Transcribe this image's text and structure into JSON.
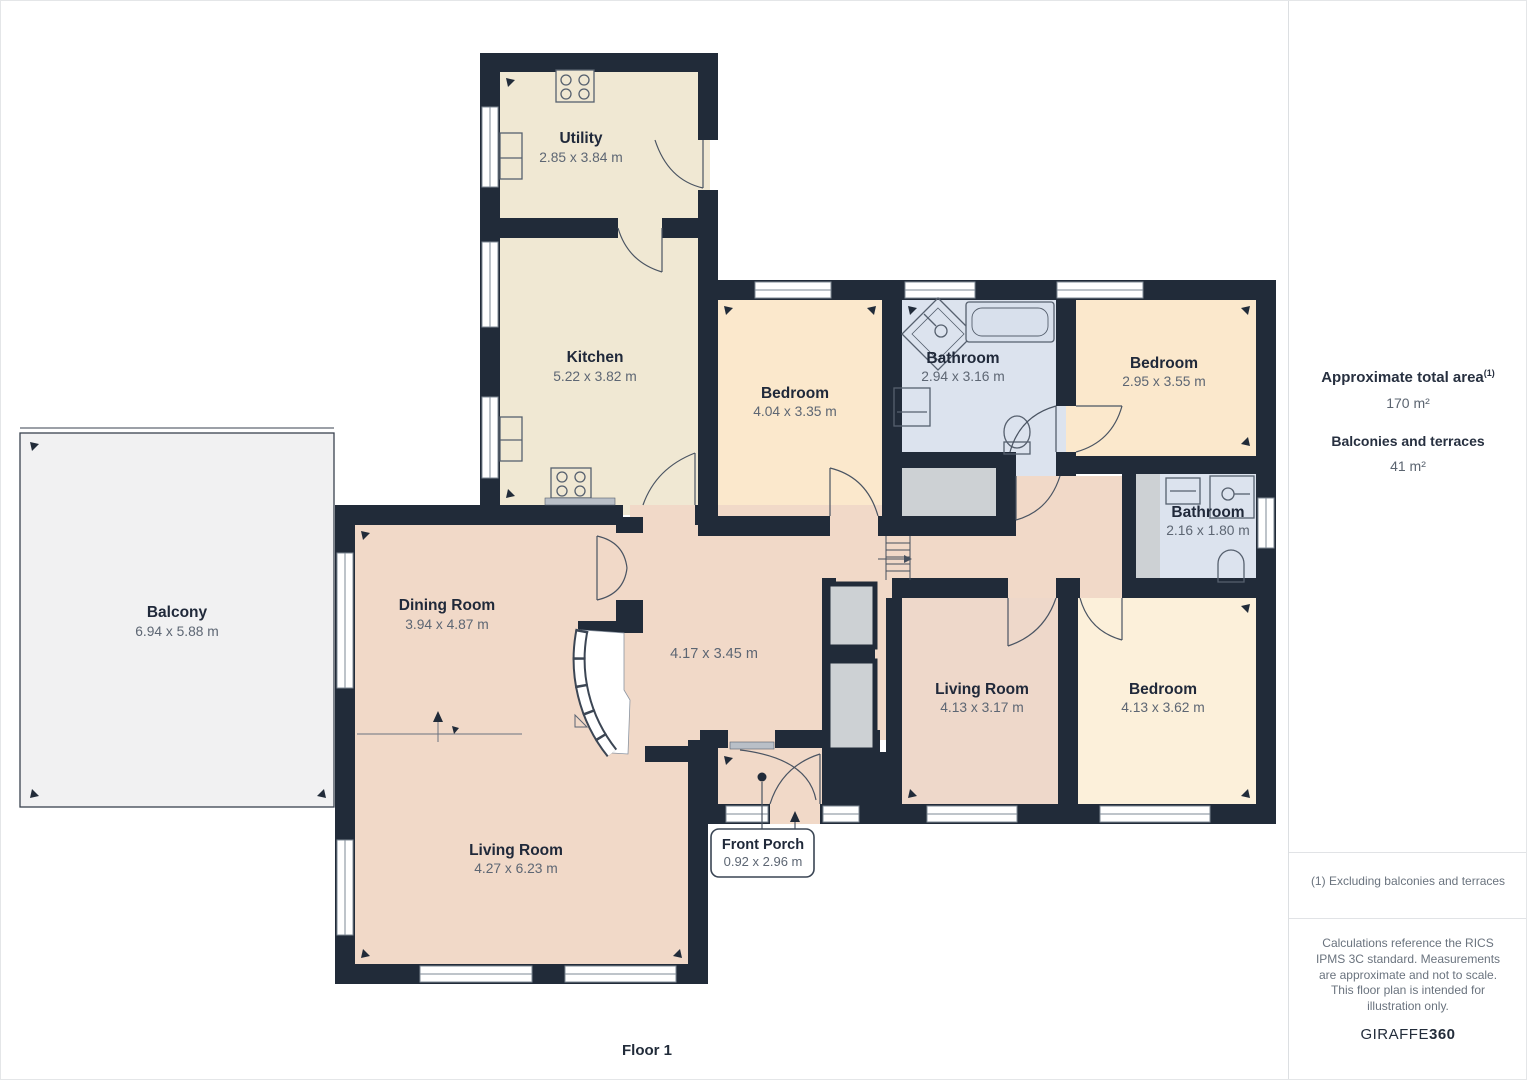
{
  "colors": {
    "wall": "#212b39",
    "room_warm": "#fbe8cc",
    "room_cream": "#fcf0da",
    "room_beige": "#f0e8d3",
    "room_pink": "#f1d9c8",
    "room_pink_muted": "#eed8ca",
    "room_blue": "#dce3ee",
    "closet_gray": "#cdd1d4",
    "balcony_gray": "#f1f1f2"
  },
  "plan": {
    "floor_label": "Floor 1",
    "rooms": {
      "utility": {
        "name": "Utility",
        "dims": "2.85 x 3.84 m"
      },
      "kitchen": {
        "name": "Kitchen",
        "dims": "5.22 x 3.82 m"
      },
      "bedroom_top": {
        "name": "Bedroom",
        "dims": "4.04 x 3.35 m"
      },
      "bathroom_top": {
        "name": "Bathroom",
        "dims": "2.94 x 3.16 m"
      },
      "bedroom_topright": {
        "name": "Bedroom",
        "dims": "2.95 x 3.55 m"
      },
      "bathroom_right": {
        "name": "Bathroom",
        "dims": "2.16 x 1.80 m"
      },
      "dining": {
        "name": "Dining Room",
        "dims": "3.94 x 4.87 m"
      },
      "hall": {
        "dims": "4.17 x 3.45 m"
      },
      "living_main": {
        "name": "Living Room",
        "dims": "4.27 x 6.23 m"
      },
      "living_right": {
        "name": "Living Room",
        "dims": "4.13 x 3.17 m"
      },
      "bedroom_bottomright": {
        "name": "Bedroom",
        "dims": "4.13 x 3.62 m"
      },
      "balcony": {
        "name": "Balcony",
        "dims": "6.94 x 5.88 m"
      },
      "front_porch": {
        "name": "Front Porch",
        "dims": "0.92 x 2.96 m"
      }
    }
  },
  "sidebar": {
    "total_area_label": "Approximate total area",
    "total_area_sup": "(1)",
    "total_area_value": "170 m²",
    "balconies_label": "Balconies and terraces",
    "balconies_value": "41 m²",
    "footnote": "(1) Excluding balconies and terraces",
    "disclaimer": "Calculations reference the RICS IPMS 3C standard. Measurements are approximate and not to scale. This floor plan is intended for illustration only.",
    "brand_name": "GIRAFFE",
    "brand_suffix": "360"
  }
}
